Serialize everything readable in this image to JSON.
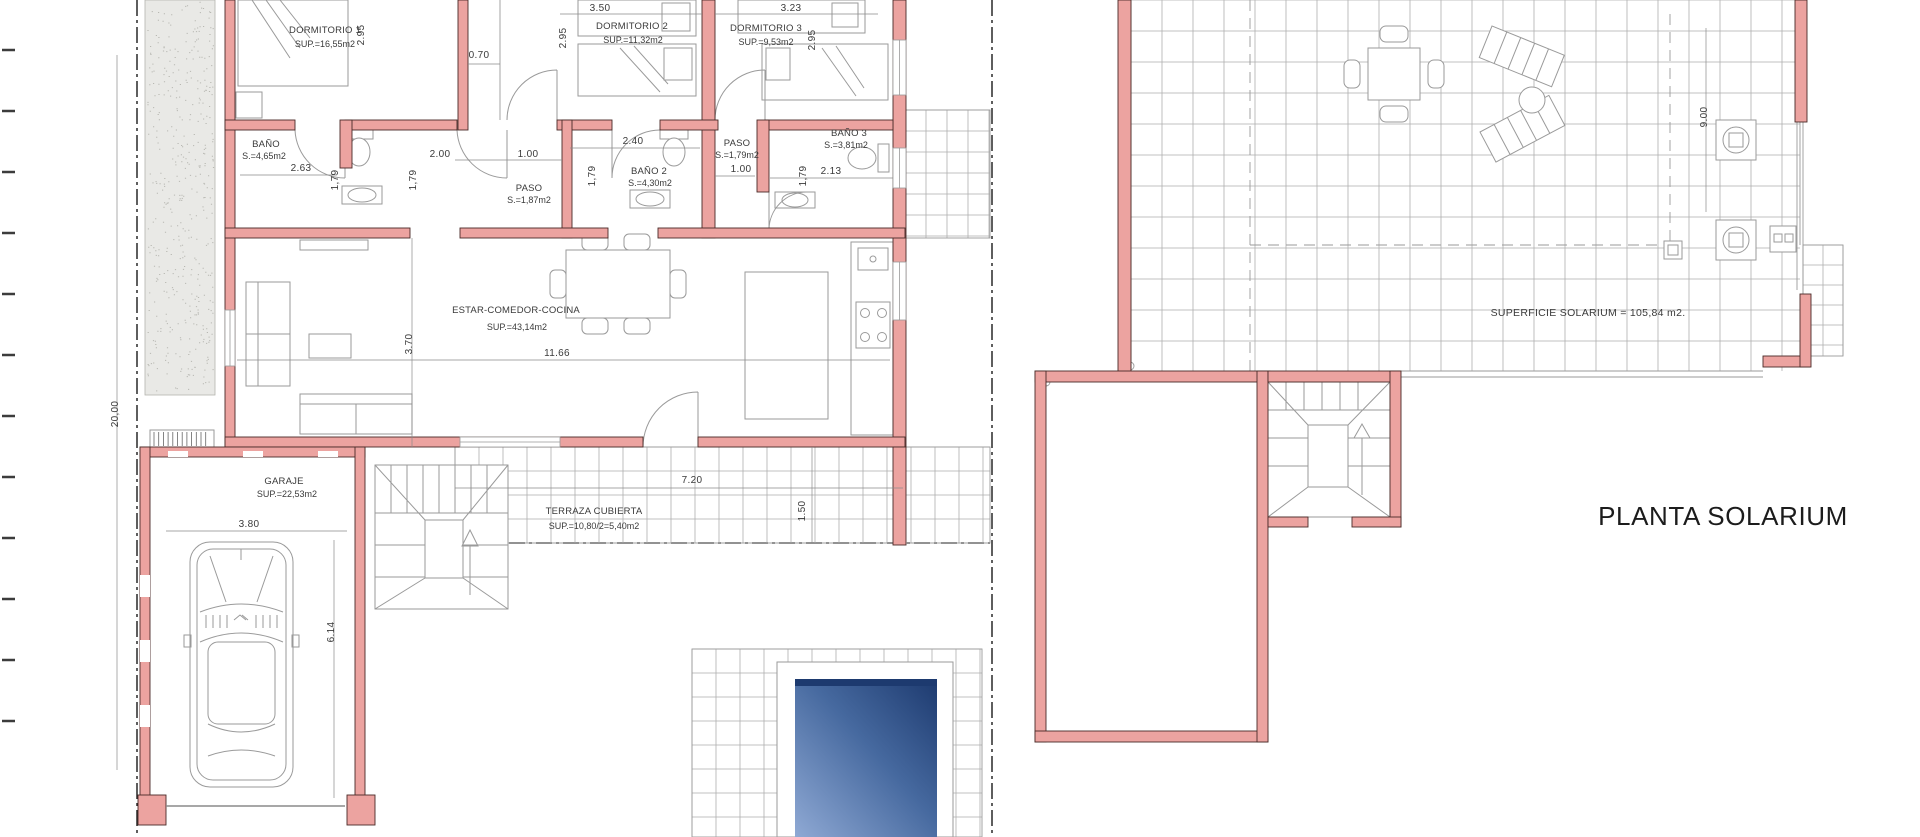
{
  "ground_floor": {
    "rooms": {
      "dormitorio1": {
        "name": "DORMITORIO 1",
        "area": "SUP.=16,55m2"
      },
      "dormitorio2": {
        "name": "DORMITORIO 2",
        "area": "SUP.=11,32m2"
      },
      "dormitorio3": {
        "name": "DORMITORIO 3",
        "area": "SUP.=9,53m2"
      },
      "bano1": {
        "name": "BAÑO",
        "area": "S.=4,65m2"
      },
      "paso1": {
        "name": "PASO",
        "area": "S.=1,87m2"
      },
      "bano2": {
        "name": "BAÑO 2",
        "area": "S.=4,30m2"
      },
      "paso2": {
        "name": "PASO",
        "area": "S.=1,79m2"
      },
      "bano3": {
        "name": "BAÑO 3",
        "area": "S.=3,81m2"
      },
      "estar": {
        "name": "ESTAR-COMEDOR-COCINA",
        "area": "SUP.=43,14m2"
      },
      "garaje": {
        "name": "GARAJE",
        "area": "SUP.=22,53m2"
      },
      "terraza": {
        "name": "TERRAZA CUBIERTA",
        "area": "SUP.=10,80/2=5,40m2"
      }
    },
    "dims": {
      "plot_height": "20,00",
      "dorm2_width": "3.50",
      "dorm3_width": "3.23",
      "dorm1_depth": "2.95",
      "dorm2_depth": "2.95",
      "dorm3_depth": "2.95",
      "pasillo": "0.70",
      "bano1_width": "2.63",
      "bano1_depth": "1,79",
      "paso1_w1": "2.00",
      "paso1_w2": "1.00",
      "paso1_depth": "1,79",
      "bano2_width": "2.40",
      "bano2_depth": "1,79",
      "paso2_width": "1.00",
      "bano3_width": "2.13",
      "bano3_depth": "1,79",
      "estar_width": "11.66",
      "estar_depth": "3.70",
      "terraza_width": "7.20",
      "terraza_depth": "1.50",
      "garaje_width": "3.80",
      "garaje_depth": "6.14"
    }
  },
  "solarium": {
    "title": "PLANTA SOLARIUM",
    "surface": "SUPERFICIE SOLARIUM = 105,84 m2.",
    "dims": {
      "depth": "9.00"
    }
  },
  "colors": {
    "wall": "#ECA3A0",
    "wall_outline": "#4A2B27",
    "drawing_line": "#9A9A9A",
    "grid_line": "#AFAFAF",
    "text": "#3A3A3A",
    "pool_light": "#8FA9D4",
    "pool_mid": "#46699F",
    "pool_dark": "#1D3A6F",
    "boundary": "#1A1A1A",
    "stipple": "#E9E9E6"
  }
}
